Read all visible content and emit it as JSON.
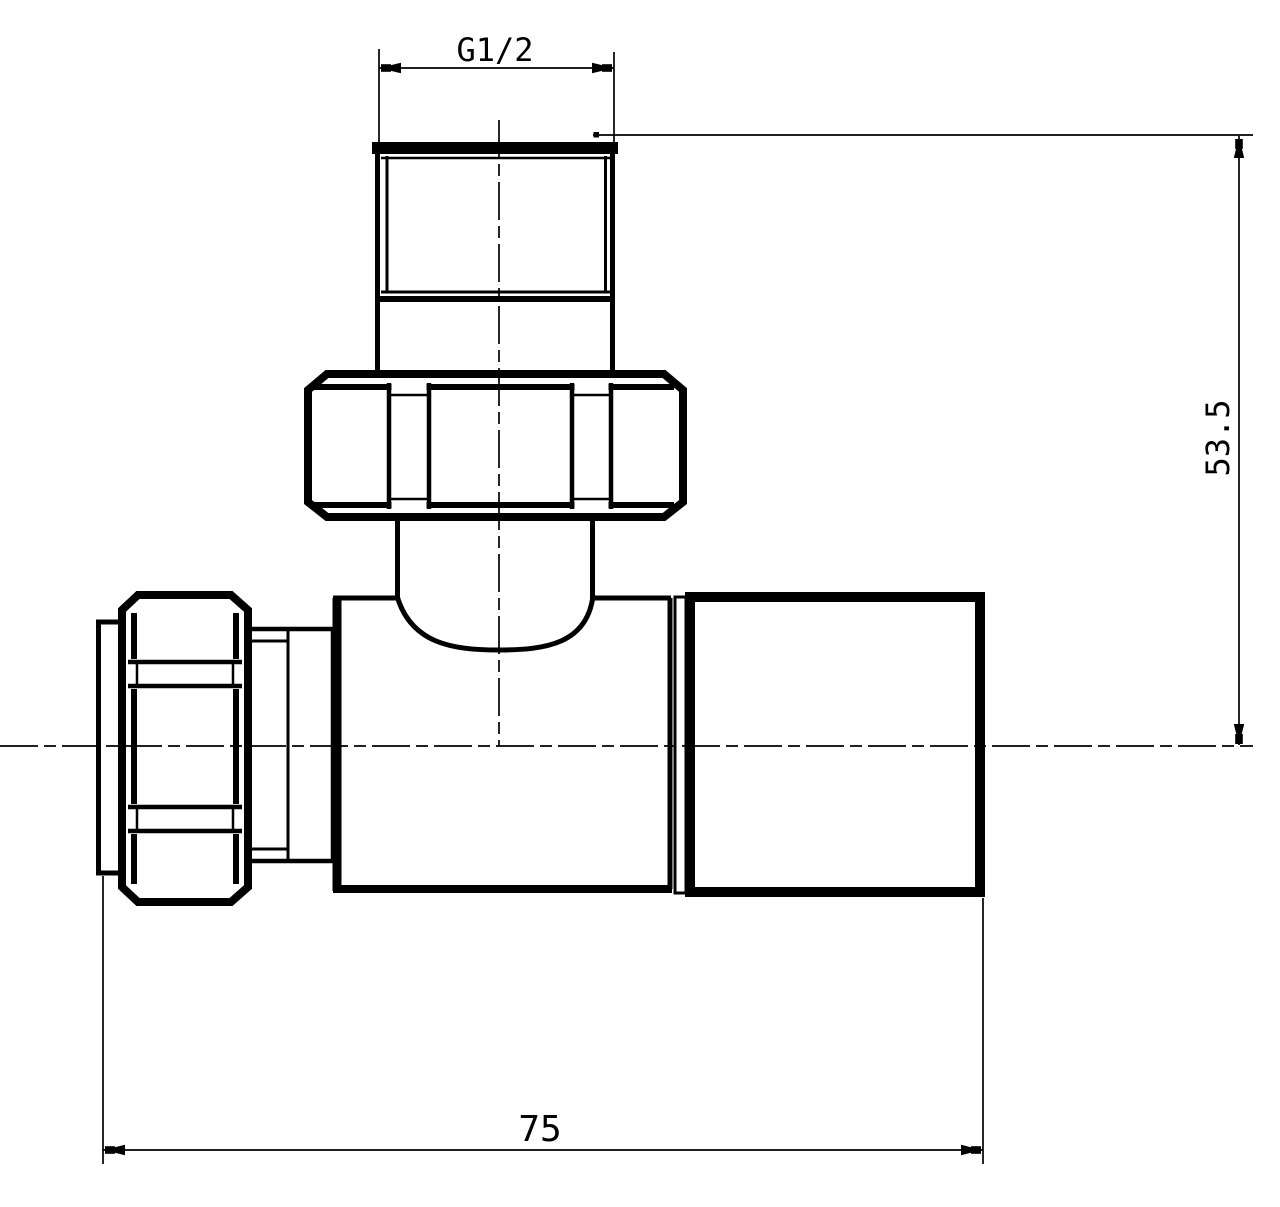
{
  "drawing": {
    "type": "technical-drawing",
    "subject": "straight-radiator-valve-side-elevation",
    "colors": {
      "line": "#000000",
      "background": "#ffffff"
    },
    "dimensions": [
      {
        "id": "thread-size",
        "label": "G1/2",
        "orientation": "horizontal",
        "location": "top"
      },
      {
        "id": "height-to-centerline",
        "label": "53.5",
        "orientation": "vertical",
        "location": "right"
      },
      {
        "id": "overall-length",
        "label": "75",
        "orientation": "horizontal",
        "location": "bottom"
      }
    ]
  }
}
